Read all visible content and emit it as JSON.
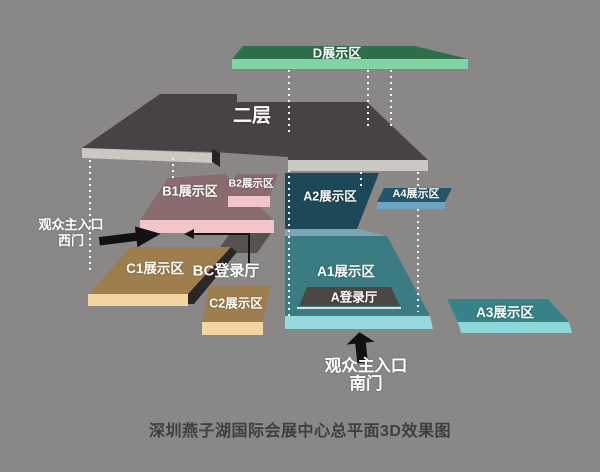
{
  "background_color": "#8a8887",
  "title": {
    "caption": "深圳燕子湖国际会展中心总平面3D效果图"
  },
  "areas": {
    "d": {
      "label": "D展示区",
      "top_color": "#2d6e4b",
      "edge_color": "#82d4a4"
    },
    "second_floor": {
      "label": "二层",
      "top_color": "#474243",
      "edge_color": "#cbc8c4"
    },
    "b1": {
      "label": "B1展示区",
      "top_color": "#8a6b6e",
      "edge_color": "#f2c5ca"
    },
    "b2": {
      "label": "B2展示区",
      "top_color": "#8a6b6e",
      "edge_color": "#f2c5ca"
    },
    "a2": {
      "label": "A2展示区",
      "top_color": "#1d4858",
      "edge_color": "#7ca6b6"
    },
    "a4": {
      "label": "A4展示区",
      "top_color": "#24566a",
      "edge_color": "#6fa3c4"
    },
    "a1": {
      "label": "A1展示区",
      "top_color": "#3b7c82",
      "edge_color": "#98d9dd"
    },
    "a_hall": {
      "label": "A登录厅",
      "top_color": "#4b4744"
    },
    "a3": {
      "label": "A3展示区",
      "top_color": "#37838a",
      "edge_color": "#8ed8da"
    },
    "c1": {
      "label": "C1展示区",
      "top_color": "#9e7e4f",
      "edge_color": "#f2d6a2"
    },
    "c2": {
      "label": "C2展示区",
      "top_color": "#9e7e4f",
      "edge_color": "#f2d6a2"
    },
    "bc_hall": {
      "label": "BC登录厅",
      "top_color": "#57524d"
    }
  },
  "entrances": {
    "west": {
      "line1": "观众主入口",
      "line2": "西门"
    },
    "south": {
      "line1": "观众主入口",
      "line2": "南门"
    }
  }
}
